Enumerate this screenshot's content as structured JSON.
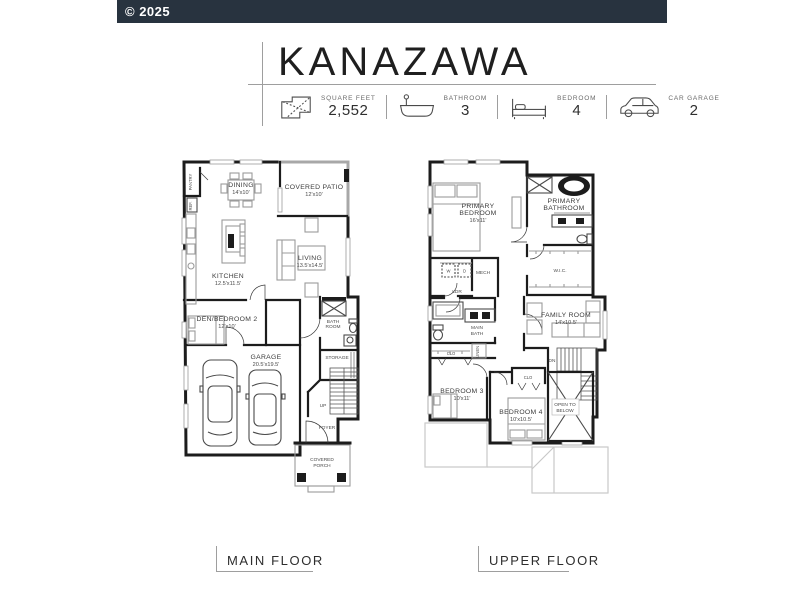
{
  "header": {
    "copyright": "© 2025"
  },
  "title": "KANAZAWA",
  "stats": {
    "sqft": {
      "label": "SQUARE FEET",
      "value": "2,552",
      "icon": "floorplan-icon"
    },
    "bath": {
      "label": "BATHROOM",
      "value": "3",
      "icon": "bathtub-icon"
    },
    "bed": {
      "label": "BEDROOM",
      "value": "4",
      "icon": "bed-icon"
    },
    "garage": {
      "label": "CAR GARAGE",
      "value": "2",
      "icon": "car-icon"
    }
  },
  "colors": {
    "header_bg": "#28333F",
    "wall": "#1C1C1C",
    "furniture": "#9B9B9B",
    "roof_outline": "#C9C9C9",
    "rule": "#9E9E9E"
  },
  "main_floor": {
    "caption": "MAIN FLOOR",
    "rooms": {
      "pantry": "PANTRY",
      "ref": "REF.",
      "dining": {
        "name": "DINING",
        "dims": "14'x10'"
      },
      "patio": {
        "name": "COVERED PATIO",
        "dims": "12'x10'"
      },
      "kitchen": {
        "name": "KITCHEN",
        "dims": "12.5'x11.5'"
      },
      "living": {
        "name": "LIVING",
        "dims": "13.5'x14.5'"
      },
      "den": {
        "name": "DEN/BEDROOM 2",
        "dims": "12'x10'"
      },
      "garage": {
        "name": "GARAGE",
        "dims": "20.5'x19.5'"
      },
      "bath": {
        "l1": "BATH",
        "l2": "ROOM"
      },
      "storage": "STORAGE",
      "up": "UP",
      "foyer": "FOYER",
      "porch": {
        "l1": "COVERED",
        "l2": "PORCH"
      }
    }
  },
  "upper_floor": {
    "caption": "UPPER FLOOR",
    "rooms": {
      "primary_bedroom": {
        "l1": "PRIMARY",
        "l2": "BEDROOM",
        "dims": "16'x11'"
      },
      "primary_bathroom": {
        "l1": "PRIMARY",
        "l2": "BATHROOM"
      },
      "washer": "W",
      "dryer": "D",
      "mech": "MECH",
      "ldr": "LDR",
      "wic": "W.I.C.",
      "main_bath": {
        "l1": "MAIN",
        "l2": "BATH"
      },
      "closet_bed3": "CLO",
      "linen": "LINEN",
      "family": {
        "name": "FAMILY ROOM",
        "dims": "14'x10.5'"
      },
      "dn": "DN",
      "closet_bed4": "CLO",
      "bedroom3": {
        "name": "BEDROOM 3",
        "dims": "10'x11'"
      },
      "bedroom4": {
        "name": "BEDROOM 4",
        "dims": "10'x10.5'"
      },
      "open_below": {
        "l1": "OPEN TO",
        "l2": "BELOW"
      }
    }
  }
}
